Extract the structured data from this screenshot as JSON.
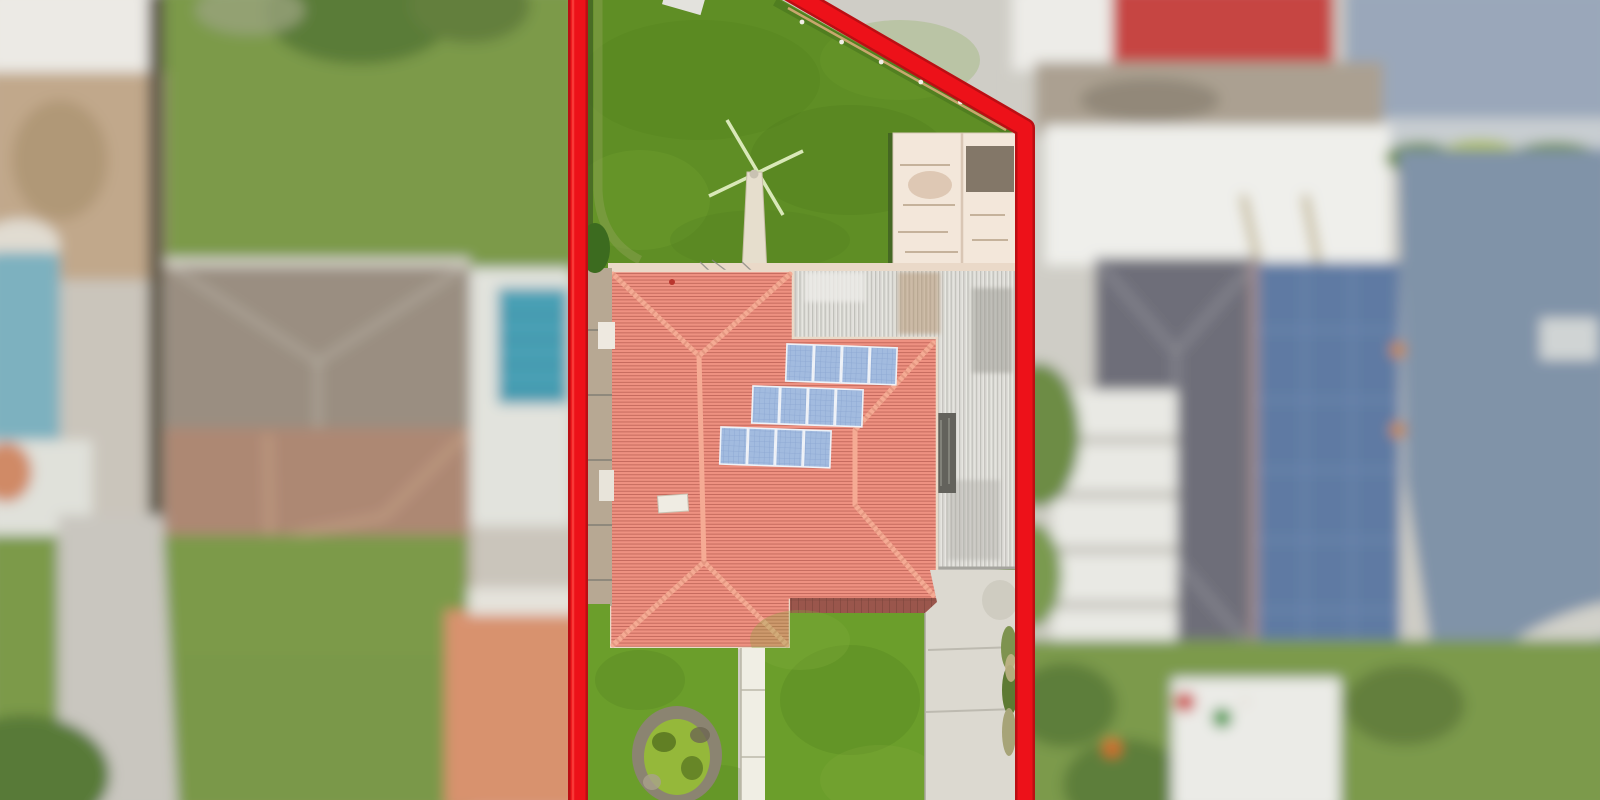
{
  "scene": {
    "type": "aerial-drone-photo",
    "subject": "residential property lot highlighted with red boundary outline, neighbouring lots blurred",
    "features": [
      "red-lot-boundary",
      "terracotta-hip-roof-house",
      "solar-panel-array",
      "wind-turbine-mast",
      "garden-shed",
      "corrugated-carport-roof",
      "concrete-driveway",
      "front-walkway",
      "circular-garden-bed",
      "back-lawn",
      "front-lawn",
      "neighbour-pool",
      "neighbour-canal"
    ]
  },
  "colors": {
    "red_outline": "#ed1119",
    "red_outline_dark": "#bb0e13",
    "back_lawn": "#5f8e25",
    "front_lawn": "#6b9e2b",
    "roof_tile_base": "#ee9181",
    "roof_ridge": "#f5ab94",
    "roof_eave_dark": "#9a564c",
    "gutter_cream": "#ead9c8",
    "solar_panel": "#a2bbdf",
    "solar_frame": "#eef2f8",
    "carport_base": "#dddcd7",
    "skylight_dark": "#63625c",
    "shed_base": "#f3e7da",
    "shed_rust": "#6f6353",
    "side_path_tan": "#b7a893",
    "walkway_white": "#f0eee4",
    "driveway_gray": "#dcd9d0",
    "garden_rim": "#8b8471",
    "garden_bush": "#95b83a",
    "turbine_pole": "#e6decd",
    "turbine_blade": "#d9e8b8",
    "fence_line_tan": "#c8a76e",
    "post_white": "#f2efe6",
    "neighbor_left": {
      "white_roof": "#eceae5",
      "dirt": "#c1a88b",
      "fence_dark": "#5f584a",
      "lawn": "#7c9a4a",
      "tree": "#5a7b37",
      "pool": "#4aa0b5",
      "pool_left": "#7db1bf",
      "deck": "#e2e3dd",
      "roof_upper": "#9a8e81",
      "roof_lower": "#ad8873",
      "driveway": "#c9c6bf",
      "patio_salmon": "#d8926e"
    },
    "neighbor_right": {
      "white_roof": "#edece8",
      "red_roof": "#c64542",
      "clutter": "#aba091",
      "big_shed": "#efefeb",
      "water": "#8093a8",
      "water_top": "#9aa7ba",
      "roof_dark": "#6e6e79",
      "solar_blue": "#5e7aa3",
      "veranda": "#e9e9e4",
      "lawn": "#7b9a4b",
      "tree": "#5d7e3b",
      "small_shed": "#ebebe7",
      "curve_path": "#d2d1ca"
    }
  },
  "boundary": {
    "left_line": {
      "x": 578,
      "y1": -12,
      "y2": 812
    },
    "right_polyline": "780,-14 1025,128 1025,814",
    "stroke_width": 15,
    "under_stroke_width": 20
  },
  "solar": {
    "rows": [
      {
        "x": 787,
        "y": 344
      },
      {
        "x": 753,
        "y": 386
      },
      {
        "x": 721,
        "y": 427
      }
    ],
    "panels_per_row": 4,
    "panel_w": 26.5,
    "panel_h": 37,
    "gap": 1.4,
    "tilt_deg": 2
  },
  "fence_posts": {
    "x1": 802,
    "y1": 22,
    "x2": 1000,
    "y2": 122,
    "count": 6
  },
  "pool_lanes": {
    "x1": 500,
    "x2": 565,
    "ys": [
      315,
      340,
      365,
      390
    ]
  }
}
